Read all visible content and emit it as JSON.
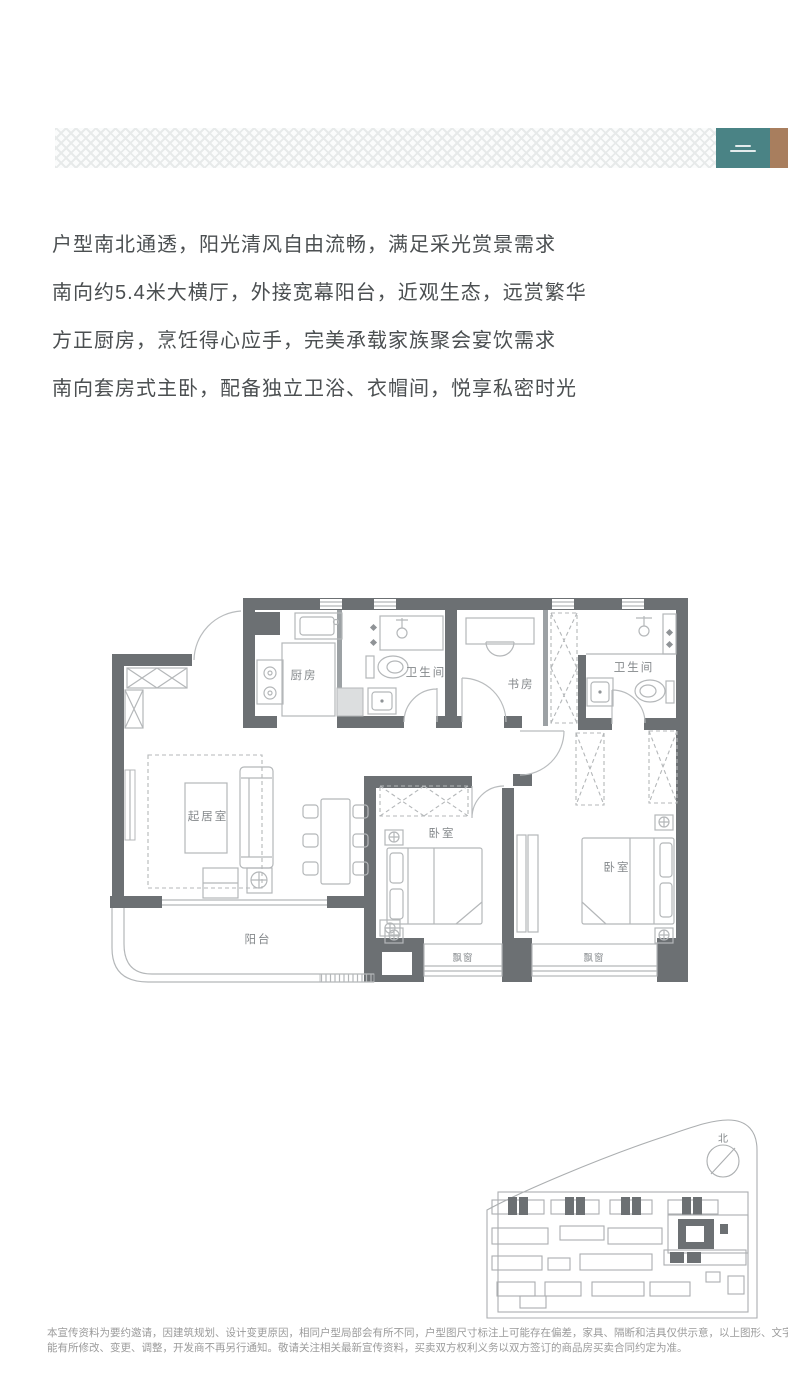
{
  "header": {
    "brand_block_color": "#4a8385",
    "brand_strip_color": "#a87e5e"
  },
  "marketing": {
    "lines": {
      "0": "户型南北通透，阳光清风自由流畅，满足采光赏景需求",
      "1": "南向约5.4米大横厅，外接宽幕阳台，近观生态，远赏繁华",
      "2": "方正厨房，烹饪得心应手，完美承载家族聚会宴饮需求",
      "3": "南向套房式主卧，配备独立卫浴、衣帽间，悦享私密时光"
    }
  },
  "floor_plan": {
    "rooms": {
      "kitchen": "厨房",
      "bath1": "卫生间",
      "study": "书房",
      "bath2": "卫生间",
      "living": "起居室",
      "balcony": "阳台",
      "bedroom1": "卧室",
      "bedroom2": "卧室",
      "bay1": "飘窗",
      "bay2": "飘窗"
    },
    "wall_color": "#6c7073",
    "furniture_color": "#b4b7b9"
  },
  "site_plan": {
    "north_label": "北"
  },
  "disclaimer": {
    "line1": "本宣传资料为要约邀请，因建筑规划、设计变更原因，相同户型局部会有所不同，户型图尺寸标注上可能存在偏差，家具、隔断和洁具仅供示意，以上图形、文字今后可",
    "line2": "能有所修改、变更、调整，开发商不再另行通知。敬请关注相关最新宣传资料，买卖双方权利义务以双方签订的商品房买卖合同约定为准。"
  }
}
